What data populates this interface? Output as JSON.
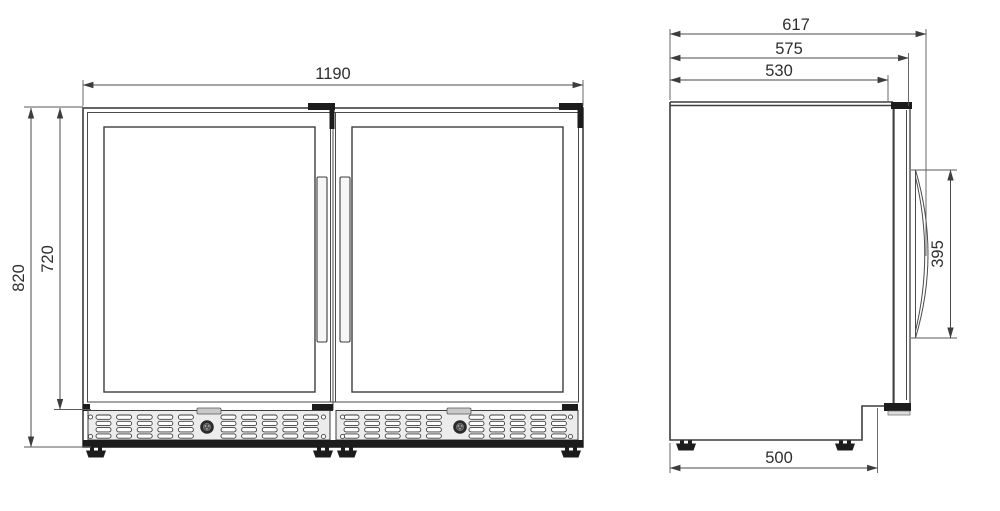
{
  "drawing": {
    "kind": "technical-dimension-drawing",
    "subject": "double glass-door beverage cooler, front and side elevations",
    "views": {
      "front": {
        "name": "front-view",
        "dims": {
          "overall_width_mm": "1190",
          "overall_height_mm": "820",
          "door_height_mm": "720"
        }
      },
      "side": {
        "name": "side-view",
        "dims": {
          "overall_depth_mm": "617",
          "depth_excl_handle_mm": "575",
          "cabinet_depth_mm": "530",
          "handle_length_mm": "395",
          "base_depth_mm": "500"
        }
      }
    },
    "colors": {
      "background": "#ffffff",
      "line": "#3d3d3d",
      "dark_fill": "#1c1c1c",
      "panel_fill": "#ececec"
    }
  }
}
